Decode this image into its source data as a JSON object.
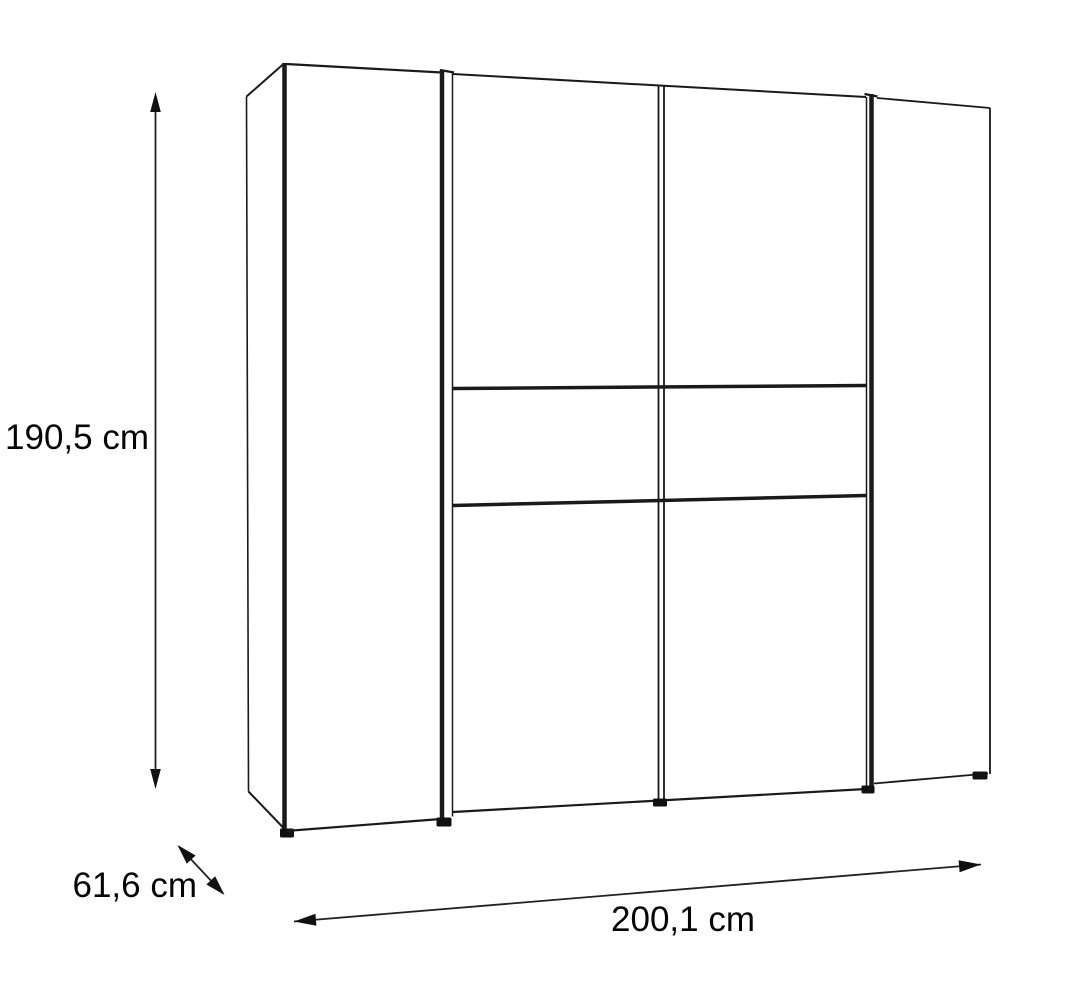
{
  "diagram": {
    "type": "furniture-dimension-drawing",
    "subject": "sliding-door wardrobe, front-left perspective line drawing",
    "unit": "cm",
    "dimensions": {
      "height_label": "190,5 cm",
      "depth_label": "61,6 cm",
      "width_label": "200,1 cm"
    },
    "colors": {
      "background": "#ffffff",
      "line": "#1a1a1a",
      "text": "#050505"
    }
  }
}
